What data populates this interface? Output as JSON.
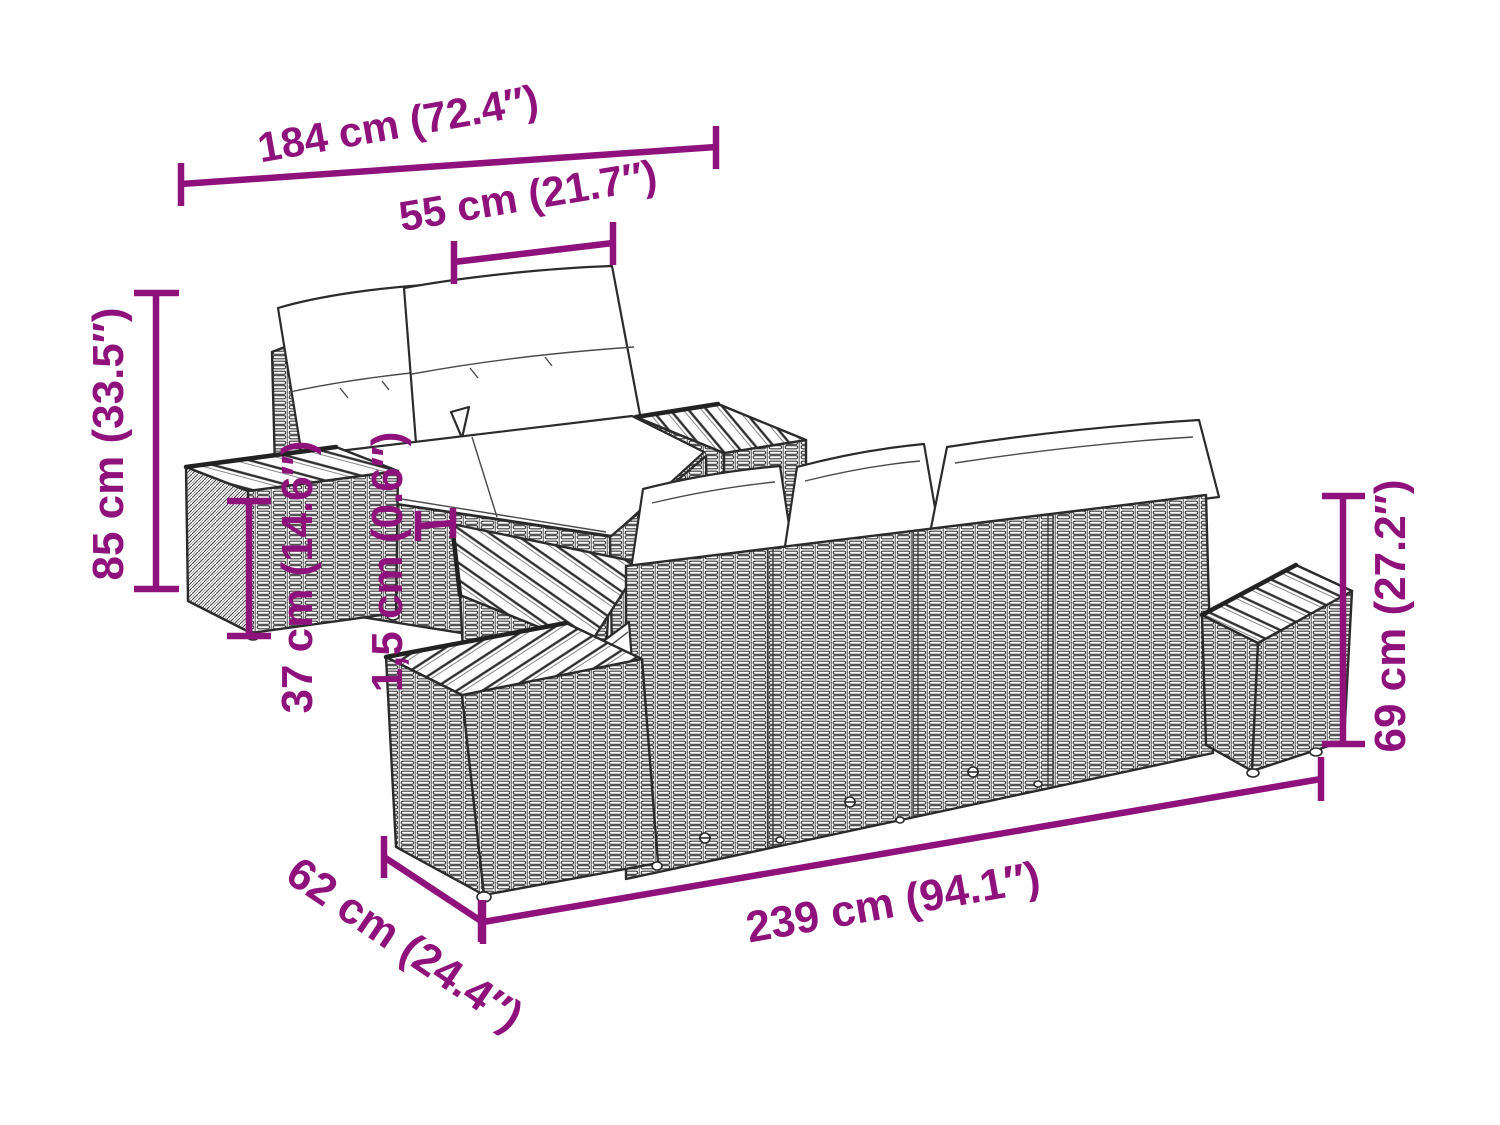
{
  "diagram": {
    "kind": "furniture-dimension-diagram",
    "background_color": "#ffffff",
    "dimension_color": "#8F127C",
    "drawing_line_color": "#2b2b2b",
    "cushion_color": "#ffffff"
  },
  "dimensions": {
    "total_width": {
      "label": "184 cm (72.4″)"
    },
    "seat_width": {
      "label": "55 cm (21.7″)"
    },
    "total_height": {
      "label": "85 cm (33.5″)"
    },
    "table_height": {
      "label": "37 cm (14.6″)"
    },
    "tabletop_thickness": {
      "label": "1,5 cm (0.6″)"
    },
    "back_height": {
      "label": "69 cm (27.2″)"
    },
    "total_length": {
      "label": "239 cm (94.1″)"
    },
    "depth": {
      "label": "62 cm (24.4″)"
    }
  }
}
